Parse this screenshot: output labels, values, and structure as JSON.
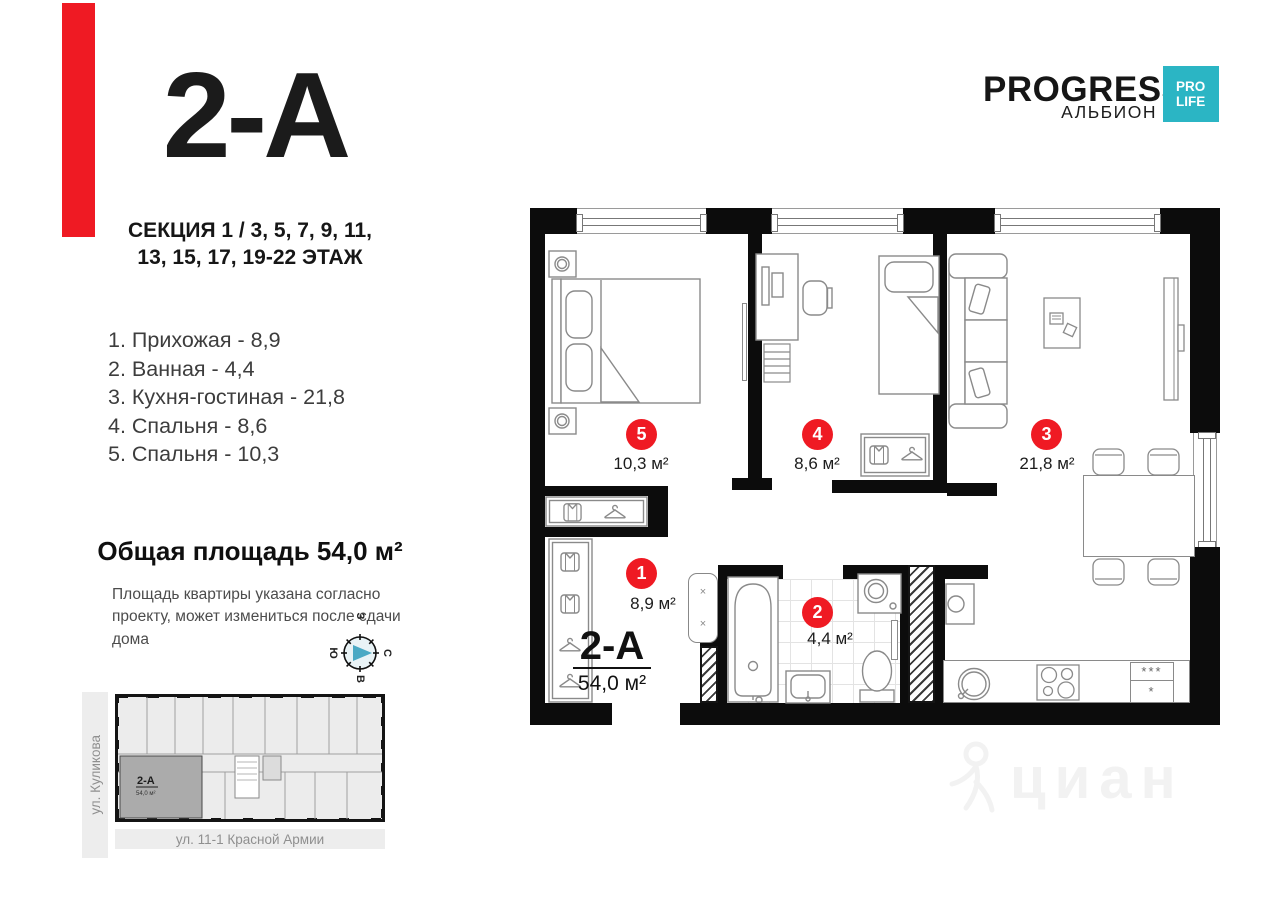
{
  "brand": {
    "name": "PROGRESS",
    "subtitle": "АЛЬБИОН",
    "badge": {
      "line1": "PRO",
      "line2": "LIFE",
      "color": "#2bb5c4"
    }
  },
  "unit": {
    "code": "2-А",
    "section_line1": "СЕКЦИЯ 1 / 3, 5, 7, 9, 11,",
    "section_line2": "13, 15, 17, 19-22 ЭТАЖ",
    "total_area_heading": "Общая площадь 54,0 м²",
    "note_line1": "Площадь квартиры указана согласно",
    "note_line2": "проекту, может измениться после сдачи дома",
    "accent_color": "#ef1a23"
  },
  "room_list": [
    "1.  Прихожая - 8,9",
    "2. Ванная - 4,4",
    "3. Кухня-гостиная - 21,8",
    "4. Спальня - 8,6",
    "5. Спальня - 10,3"
  ],
  "plan": {
    "unit_code": "2-А",
    "unit_area": "54,0 м²",
    "markers": [
      {
        "num": "1",
        "area": "8,9 м²"
      },
      {
        "num": "2",
        "area": "4,4 м²"
      },
      {
        "num": "3",
        "area": "21,8 м²"
      },
      {
        "num": "4",
        "area": "8,6 м²"
      },
      {
        "num": "5",
        "area": "10,3 м²"
      }
    ],
    "fridge_marks_top": "***",
    "fridge_marks_bottom": "*",
    "cabinet_mark_1": "×",
    "cabinet_mark_2": "×"
  },
  "compass": {
    "north": "С",
    "east": "В",
    "south": "Ю",
    "west": "З"
  },
  "minimap": {
    "unit_code": "2-А",
    "unit_area": "54,0 м²",
    "street_left": "ул. Куликова",
    "street_bottom": "ул. 11-1 Красной Армии"
  },
  "watermark": "циан"
}
